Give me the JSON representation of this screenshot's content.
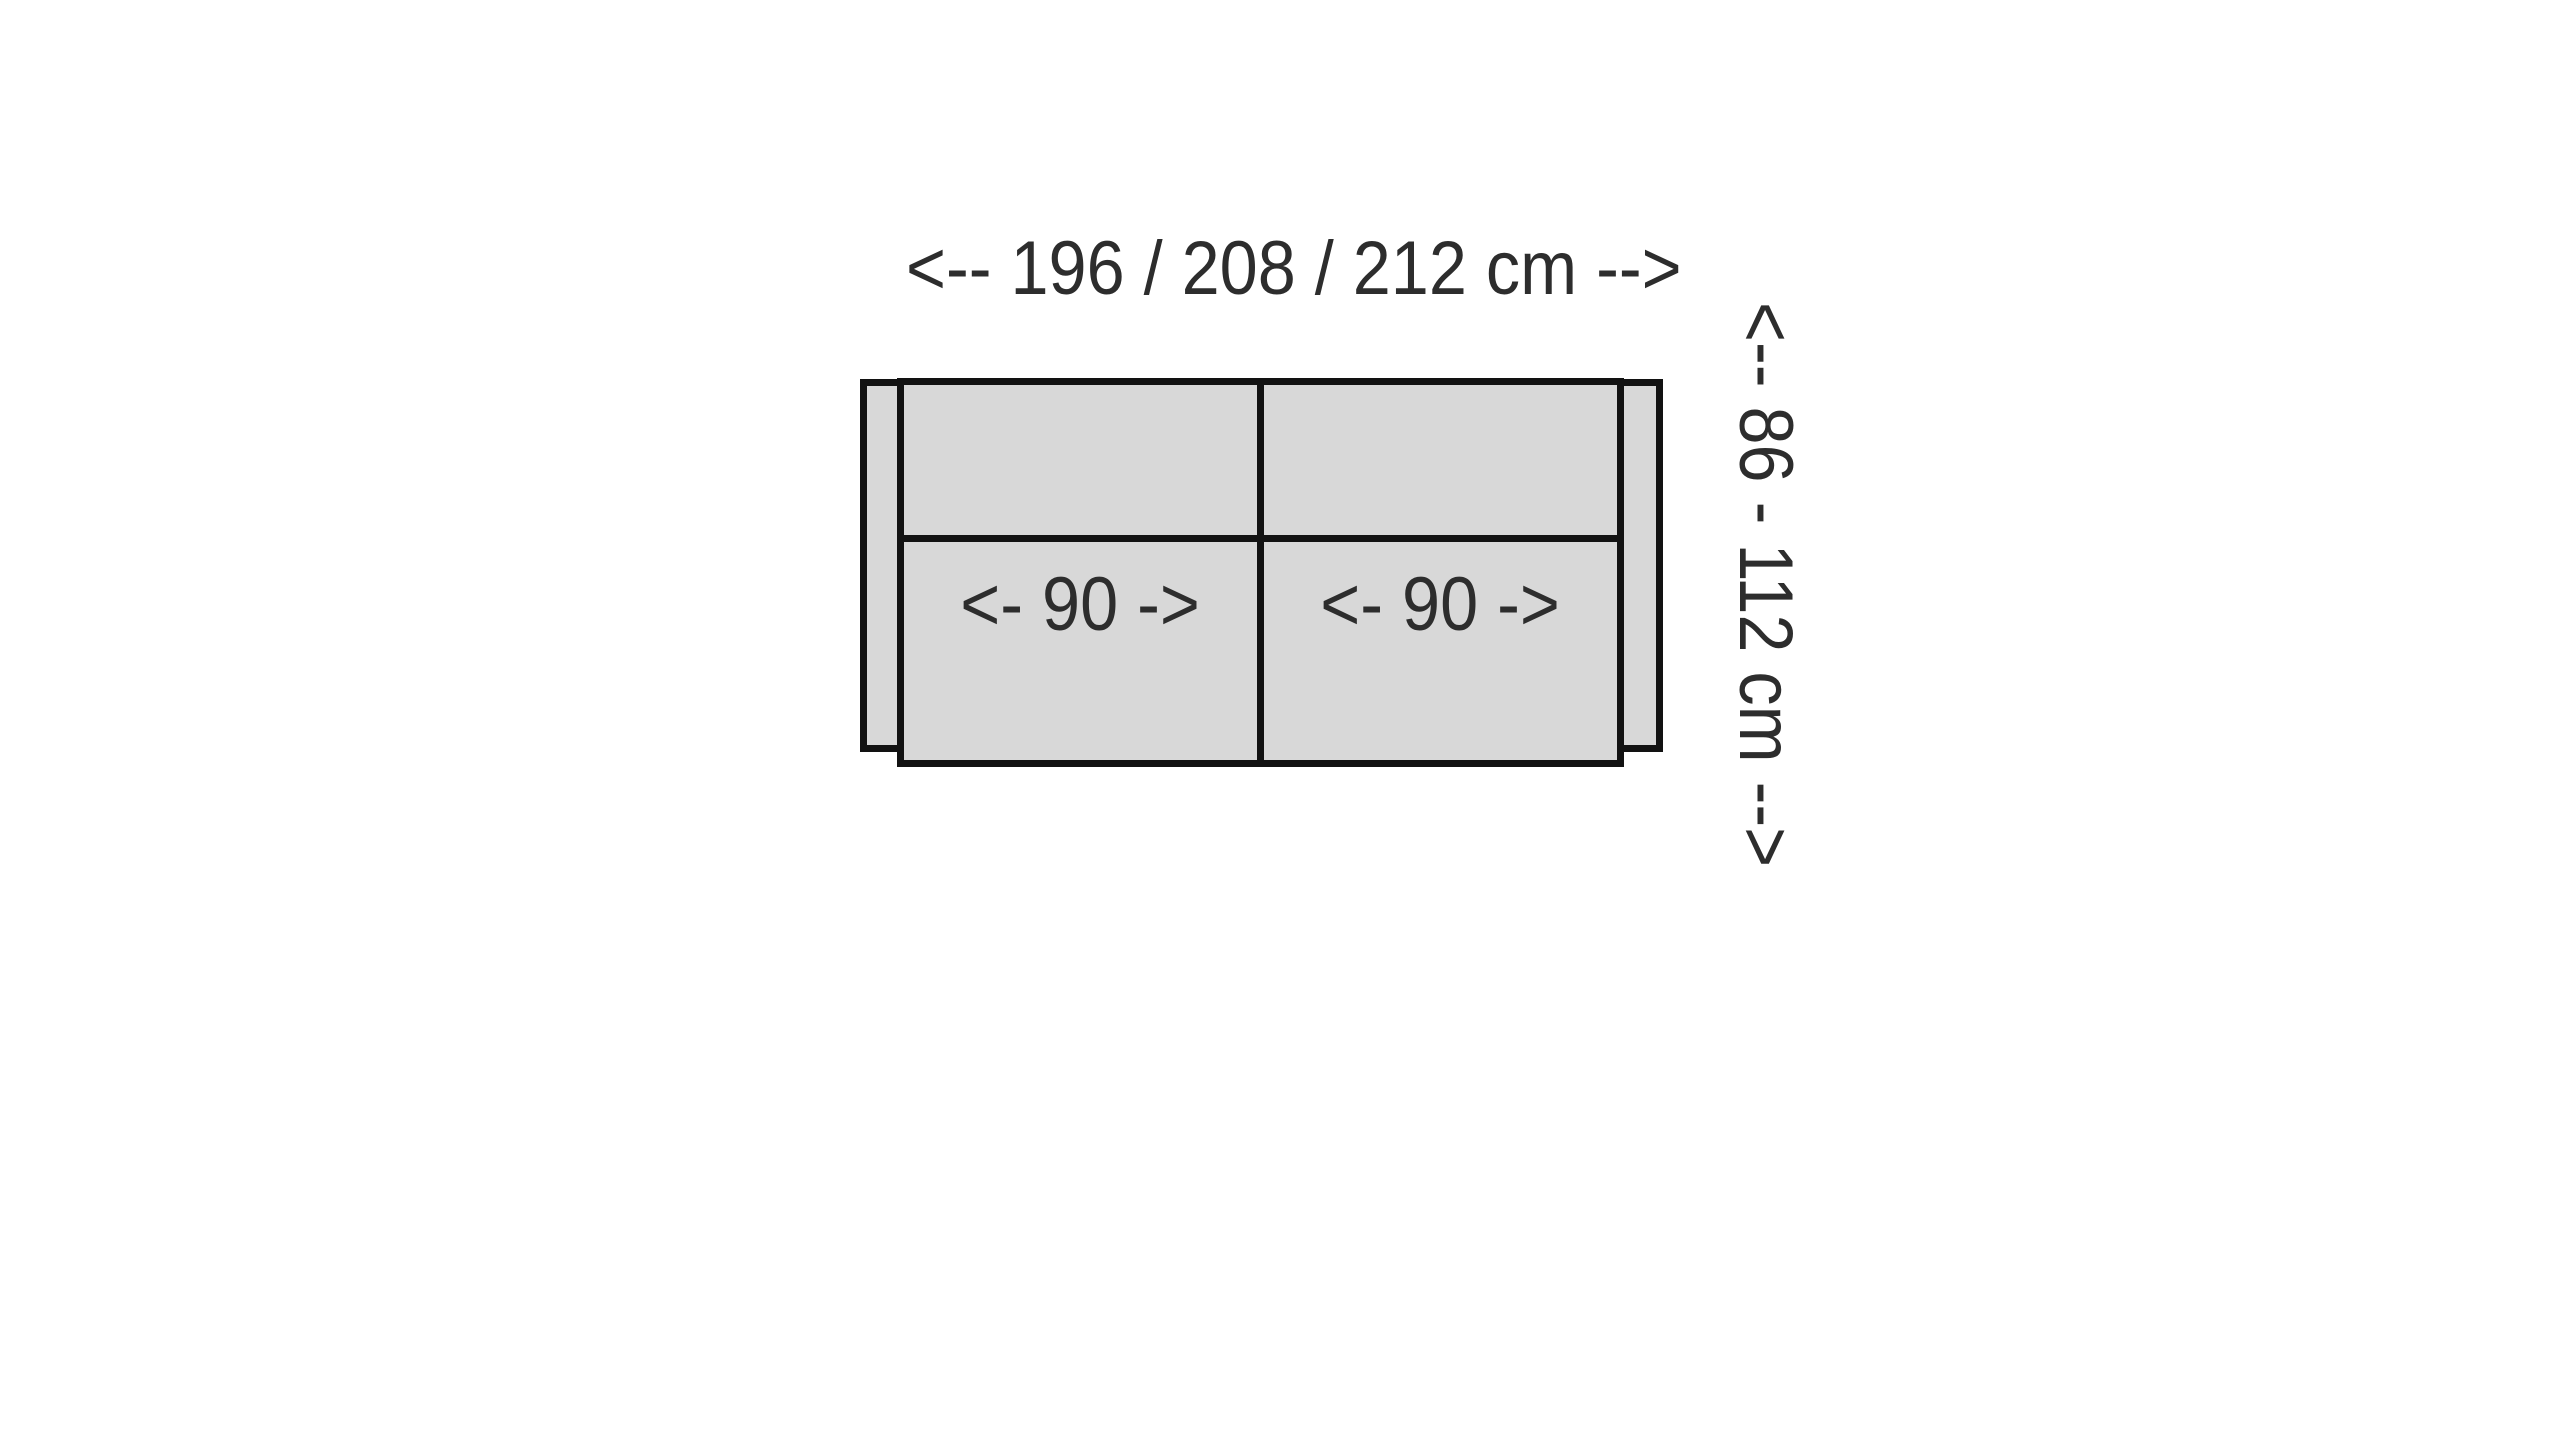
{
  "diagram": {
    "width_label": "<-- 196 / 208 / 212 cm -->",
    "depth_label": "<-- 86 - 112 cm -->",
    "seats": [
      {
        "label": "<- 90 ->"
      },
      {
        "label": "<- 90 ->"
      }
    ],
    "colors": {
      "fill": "#d8d8d8",
      "outline": "#121212",
      "text": "#2d2d2d",
      "background": "#ffffff"
    }
  }
}
